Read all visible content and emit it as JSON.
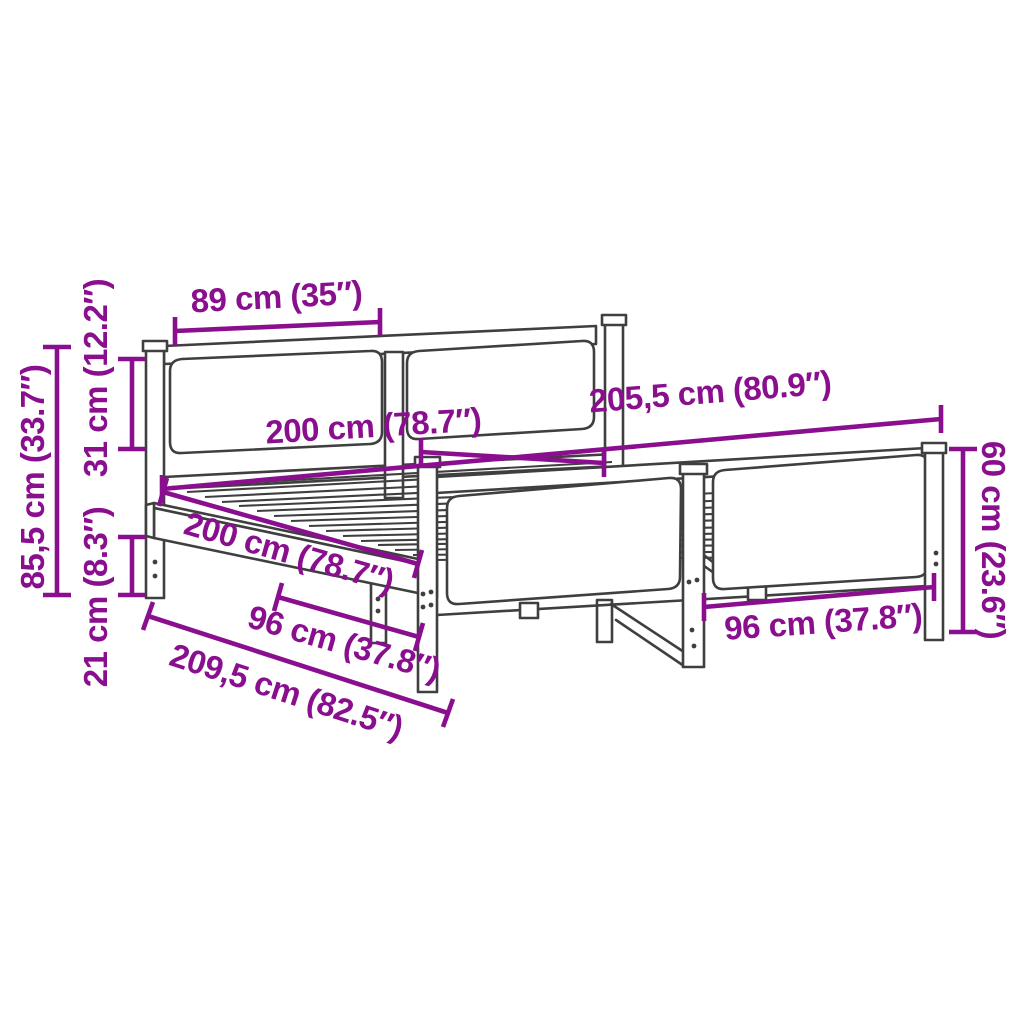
{
  "image": {
    "title": "Bed frame dimension diagram",
    "colors": {
      "dimension_annotation": "#8a0f8f",
      "frame_outline": "#3f3f3f",
      "background": "#ffffff"
    },
    "dimensions": {
      "headboard_cushion_width": {
        "label": "89 cm (35″)"
      },
      "headboard_height": {
        "label": "85,5 cm (33.7″)"
      },
      "headboard_cushion_height": {
        "label": "31 cm (12.2″)"
      },
      "under_bed_clearance": {
        "label": "21 cm (8.3″)"
      },
      "inner_length_upper": {
        "label": "200 cm (78.7″)"
      },
      "total_width": {
        "label": "205,5 cm (80.9″)"
      },
      "inner_length_diagonal": {
        "label": "200 cm (78.7″)"
      },
      "total_length": {
        "label": "209,5 cm (82.5″)"
      },
      "footboard_cushion_width_left": {
        "label": "96 cm (37.8″)"
      },
      "footboard_cushion_width_right": {
        "label": "96 cm (37.8″)"
      },
      "footboard_height": {
        "label": "60 cm (23.6″)"
      }
    }
  }
}
